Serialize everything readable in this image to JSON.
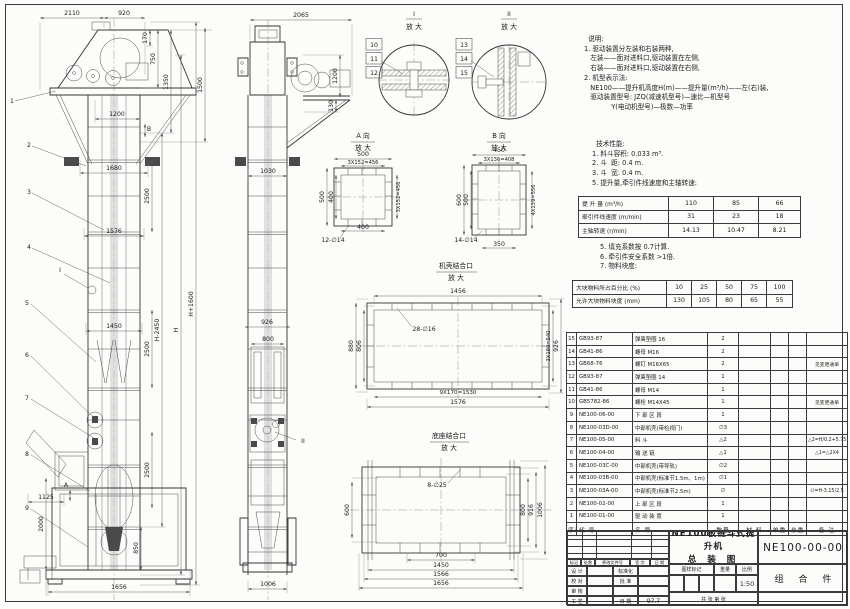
{
  "sheet": {
    "bg": "#fcfcfa",
    "line_color": "#3a3a3a",
    "scale": "1:50"
  },
  "notes": {
    "title": "说明:",
    "lines": [
      "1. 驱动装置分左装和右装两种,",
      "   左装——面对进料口,驱动装置在左侧,",
      "   右装——面对进料口,驱动装置在右侧,",
      "2. 机型表示法:",
      "   NE100——提升机高度H(m)——提升量(m³/h)——左(右)装,",
      "   驱动装置型号: JZQ(减速机型号)—速比—机型号",
      "             Y(电动机型号)—极数—功率"
    ]
  },
  "tech": {
    "title": "技术性能:",
    "items_a": [
      "1. 料斗容积: 0.033 m³.",
      "2. 斗  距: 0.4 m.",
      "3. 斗  宽: 0.4 m.",
      "5. 提升量,牵引件线速度和主轴转速:"
    ],
    "perf_table": {
      "rows": [
        [
          "提 升 量  (m³/h)",
          "110",
          "85",
          "66"
        ],
        [
          "牵引件线速度 (m/min)",
          "31",
          "23",
          "18"
        ],
        [
          "主轴转速 (r/min)",
          "14.13",
          "10.47",
          "8.21"
        ]
      ]
    },
    "items_b": [
      "5. 填充系数按 0.7计算.",
      "6. 牵引件安全系数 >1倍.",
      "7. 物料块度:"
    ],
    "lump_table": {
      "rows": [
        [
          "大块物料所占百分比 (%)",
          "10",
          "25",
          "50",
          "75",
          "100"
        ],
        [
          "允许大块物料块度 (mm)",
          "130",
          "105",
          "80",
          "65",
          "55"
        ]
      ]
    }
  },
  "bom": {
    "headers": [
      "序号",
      "代  号",
      "名      称",
      "数量",
      "材  料",
      "单重",
      "总重",
      "备  注"
    ],
    "rows": [
      [
        "15",
        "GB93-87",
        "弹簧垫圈  16",
        "2",
        "",
        "",
        "",
        ""
      ],
      [
        "14",
        "GB41-86",
        "螺母  M16",
        "2",
        "",
        "",
        "",
        ""
      ],
      [
        "13",
        "GB68-76",
        "螺钉  M16X65",
        "2",
        "",
        "",
        "",
        "见变更通单"
      ],
      [
        "12",
        "GB93-87",
        "弹簧垫圈  14",
        "1",
        "",
        "",
        "",
        ""
      ],
      [
        "11",
        "GB41-86",
        "螺母  M14",
        "1",
        "",
        "",
        "",
        ""
      ],
      [
        "10",
        "GB5782-86",
        "螺栓  M14X45",
        "1",
        "",
        "",
        "",
        "见变更通单"
      ],
      [
        "9",
        "NE100-06-00",
        "下 部 区 段",
        "1",
        "",
        "",
        "",
        ""
      ],
      [
        "8",
        "NE100-03D-00",
        "中部机壳(带检视门)",
        "∅3",
        "",
        "",
        "",
        ""
      ],
      [
        "7",
        "NE100-05-00",
        "料  斗",
        "△2",
        "",
        "",
        "",
        "△2=H/0.2+5.75"
      ],
      [
        "6",
        "NE100-04-00",
        "输 送 链",
        "△1",
        "",
        "",
        "",
        "△1=△2X4"
      ],
      [
        "5",
        "NE100-03C-00",
        "中部机壳(带导轨)",
        "∅2",
        "",
        "",
        "",
        ""
      ],
      [
        "4",
        "NE100-03B-00",
        "中部机壳(标准节1.5m、1m)",
        "∅1",
        "",
        "",
        "",
        ""
      ],
      [
        "3",
        "NE100-03A-00",
        "中部机壳(标准节2.5m)",
        "∅",
        "",
        "",
        "",
        "∅=H-3.15/2.5"
      ],
      [
        "2",
        "NE100-02-00",
        "上 部 区 段",
        "1",
        "",
        "",
        "",
        ""
      ],
      [
        "1",
        "NE100-01-00",
        "驱 动 装 置",
        "1",
        "",
        "",
        "",
        ""
      ]
    ]
  },
  "titleblock": {
    "rev_headers": [
      "标记",
      "处数",
      "更改文件号",
      "签 字",
      "日 期"
    ],
    "left_rows": [
      [
        "设 计",
        "",
        "标准化",
        ""
      ],
      [
        "校 对",
        "",
        "批 准",
        ""
      ],
      [
        "审 核",
        "",
        "",
        ""
      ],
      [
        "工 艺",
        "",
        "日 期",
        "97.7"
      ]
    ],
    "title_line1": "NE100板链斗式提升机",
    "title_line2": "总  装  图",
    "stamp_headers": [
      "图样标记",
      "重量",
      "比例"
    ],
    "scale": "1:50",
    "sheet_note": "共  张  第  张",
    "drawing_no": "NE100-00-00",
    "part_type": "组 合 件"
  },
  "drawing": {
    "labels": [
      {
        "t": "2110",
        "x": 72,
        "y": 15
      },
      {
        "t": "920",
        "x": 124,
        "y": 15
      },
      {
        "t": "170",
        "x": 147,
        "y": 38,
        "r": 1
      },
      {
        "t": "750",
        "x": 155,
        "y": 59,
        "r": 1
      },
      {
        "t": "1350",
        "x": 168,
        "y": 82,
        "r": 1
      },
      {
        "t": "1500",
        "x": 202,
        "y": 85,
        "r": 1
      },
      {
        "t": "1200",
        "x": 117,
        "y": 116
      },
      {
        "t": "1680",
        "x": 114,
        "y": 170
      },
      {
        "t": "2500",
        "x": 149,
        "y": 196,
        "r": 1
      },
      {
        "t": "1576",
        "x": 114,
        "y": 233
      },
      {
        "t": "2500",
        "x": 149,
        "y": 349,
        "r": 1
      },
      {
        "t": "1450",
        "x": 114,
        "y": 328
      },
      {
        "t": "2500",
        "x": 149,
        "y": 470,
        "r": 1
      },
      {
        "t": "H-2450",
        "x": 159,
        "y": 330,
        "r": 1
      },
      {
        "t": "H",
        "x": 178,
        "y": 330,
        "r": 1
      },
      {
        "t": "H+1600",
        "x": 193,
        "y": 304,
        "r": 1
      },
      {
        "t": "1125",
        "x": 46,
        "y": 499
      },
      {
        "t": "2000",
        "x": 43,
        "y": 524,
        "r": 1
      },
      {
        "t": "850",
        "x": 138,
        "y": 548,
        "r": 1
      },
      {
        "t": "1656",
        "x": 119,
        "y": 589
      },
      {
        "t": "1",
        "x": 12,
        "y": 103
      },
      {
        "t": "2",
        "x": 29,
        "y": 147
      },
      {
        "t": "3",
        "x": 29,
        "y": 194
      },
      {
        "t": "4",
        "x": 29,
        "y": 249
      },
      {
        "t": "I",
        "x": 60,
        "y": 272
      },
      {
        "t": "5",
        "x": 27,
        "y": 305
      },
      {
        "t": "6",
        "x": 27,
        "y": 357
      },
      {
        "t": "7",
        "x": 27,
        "y": 400
      },
      {
        "t": "8",
        "x": 27,
        "y": 456
      },
      {
        "t": "9",
        "x": 27,
        "y": 510
      },
      {
        "t": "A",
        "x": 66,
        "y": 487
      },
      {
        "t": "B",
        "x": 149,
        "y": 131
      },
      {
        "t": "2065",
        "x": 301,
        "y": 17
      },
      {
        "t": "1200",
        "x": 337,
        "y": 76,
        "r": 1
      },
      {
        "t": "130",
        "x": 333,
        "y": 106,
        "r": 1
      },
      {
        "t": "1030",
        "x": 268,
        "y": 173
      },
      {
        "t": "926",
        "x": 267,
        "y": 324
      },
      {
        "t": "800",
        "x": 268,
        "y": 341
      },
      {
        "t": "II",
        "x": 303,
        "y": 443
      },
      {
        "t": "1006",
        "x": 268,
        "y": 586
      },
      {
        "t": "10",
        "x": 374,
        "y": 47,
        "box": 1
      },
      {
        "t": "11",
        "x": 374,
        "y": 61,
        "box": 1
      },
      {
        "t": "12",
        "x": 374,
        "y": 75,
        "box": 1
      },
      {
        "t": "13",
        "x": 464,
        "y": 47,
        "box": 1
      },
      {
        "t": "14",
        "x": 464,
        "y": 61,
        "box": 1
      },
      {
        "t": "15",
        "x": 464,
        "y": 75,
        "box": 1
      },
      {
        "t": "I",
        "x": 414,
        "y": 16
      },
      {
        "t": "放 大",
        "x": 414,
        "y": 29,
        "s": 6.8
      },
      {
        "t": "II",
        "x": 509,
        "y": 16
      },
      {
        "t": "放 大",
        "x": 509,
        "y": 29,
        "s": 6.8
      },
      {
        "t": "A 向",
        "x": 363,
        "y": 138,
        "s": 6.8
      },
      {
        "t": "放 大",
        "x": 363,
        "y": 150,
        "s": 6.8
      },
      {
        "t": "500",
        "x": 363,
        "y": 156
      },
      {
        "t": "3X152=456",
        "x": 363,
        "y": 164,
        "s": 5.2
      },
      {
        "t": "500",
        "x": 324,
        "y": 197,
        "r": 1
      },
      {
        "t": "400",
        "x": 333,
        "y": 197,
        "r": 1
      },
      {
        "t": "3X152=456",
        "x": 400,
        "y": 197,
        "r": 1,
        "s": 5.2
      },
      {
        "t": "400",
        "x": 363,
        "y": 229
      },
      {
        "t": "12-∅14",
        "x": 333,
        "y": 242
      },
      {
        "t": "B 向",
        "x": 499,
        "y": 138,
        "s": 6.8
      },
      {
        "t": "放 大",
        "x": 499,
        "y": 150,
        "s": 6.8
      },
      {
        "t": "450",
        "x": 499,
        "y": 152
      },
      {
        "t": "3X136=408",
        "x": 499,
        "y": 161,
        "s": 5.2
      },
      {
        "t": "600",
        "x": 461,
        "y": 200,
        "r": 1
      },
      {
        "t": "500",
        "x": 468,
        "y": 200,
        "r": 1
      },
      {
        "t": "4X139=556",
        "x": 535,
        "y": 200,
        "r": 1,
        "s": 5.2
      },
      {
        "t": "14-∅14",
        "x": 466,
        "y": 242
      },
      {
        "t": "350",
        "x": 499,
        "y": 246
      },
      {
        "t": "机壳结合口",
        "x": 456,
        "y": 268,
        "s": 6.8
      },
      {
        "t": "放 大",
        "x": 456,
        "y": 280,
        "s": 6.8
      },
      {
        "t": "1456",
        "x": 458,
        "y": 293
      },
      {
        "t": "28-∅16",
        "x": 424,
        "y": 331
      },
      {
        "t": "880",
        "x": 353,
        "y": 346,
        "r": 1
      },
      {
        "t": "806",
        "x": 361,
        "y": 346,
        "r": 1
      },
      {
        "t": "3X180=540",
        "x": 550,
        "y": 346,
        "r": 1,
        "s": 5.2
      },
      {
        "t": "926",
        "x": 558,
        "y": 346,
        "r": 1
      },
      {
        "t": "9X170=1530",
        "x": 458,
        "y": 394,
        "s": 5.6
      },
      {
        "t": "1576",
        "x": 458,
        "y": 404
      },
      {
        "t": "底座结合口",
        "x": 449,
        "y": 438,
        "s": 6.8
      },
      {
        "t": "放 大",
        "x": 449,
        "y": 450,
        "s": 6.8
      },
      {
        "t": "8-∅25",
        "x": 437,
        "y": 487
      },
      {
        "t": "600",
        "x": 349,
        "y": 510,
        "r": 1
      },
      {
        "t": "800",
        "x": 525,
        "y": 510,
        "r": 1
      },
      {
        "t": "916",
        "x": 533,
        "y": 510,
        "r": 1
      },
      {
        "t": "1006",
        "x": 542,
        "y": 510,
        "r": 1
      },
      {
        "t": "700",
        "x": 441,
        "y": 557
      },
      {
        "t": "1450",
        "x": 441,
        "y": 567
      },
      {
        "t": "1566",
        "x": 441,
        "y": 576
      },
      {
        "t": "1656",
        "x": 441,
        "y": 585
      }
    ]
  }
}
